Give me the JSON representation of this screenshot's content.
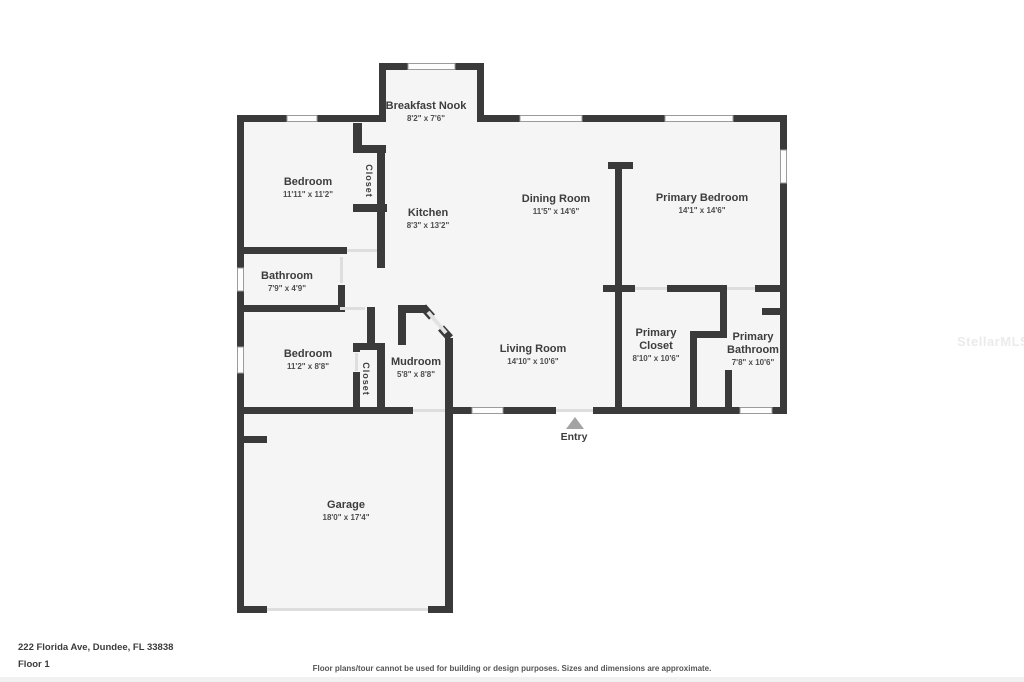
{
  "watermark": "StellarMLS",
  "entry_label": "Entry",
  "closet1_label": "Closet",
  "closet2_label": "Closet",
  "rooms": [
    {
      "name": "Breakfast Nook",
      "dims": "8'2\" x 7'6\""
    },
    {
      "name": "Bedroom",
      "dims": "11'11\" x 11'2\""
    },
    {
      "name": "Kitchen",
      "dims": "8'3\" x 13'2\""
    },
    {
      "name": "Dining Room",
      "dims": "11'5\" x 14'6\""
    },
    {
      "name": "Primary Bedroom",
      "dims": "14'1\" x 14'6\""
    },
    {
      "name": "Bathroom",
      "dims": "7'9\" x 4'9\""
    },
    {
      "name": "Bedroom",
      "dims": "11'2\" x 8'8\""
    },
    {
      "name": "Mudroom",
      "dims": "5'8\" x 8'8\""
    },
    {
      "name": "Living Room",
      "dims": "14'10\" x 10'6\""
    },
    {
      "name": "Primary Closet",
      "dims": "8'10\" x 10'6\""
    },
    {
      "name": "Primary Bathroom",
      "dims": "7'8\" x 10'6\""
    },
    {
      "name": "Garage",
      "dims": "18'0\" x 17'4\""
    }
  ],
  "footer": {
    "address": "222 Florida Ave, Dundee, FL 33838",
    "floor_label": "Floor 1",
    "disclaimer": "Floor plans/tour cannot be used for building or design purposes. Sizes and dimensions are approximate."
  },
  "colors": {
    "wall": "#3a3a3a",
    "floor": "#f5f5f5"
  }
}
